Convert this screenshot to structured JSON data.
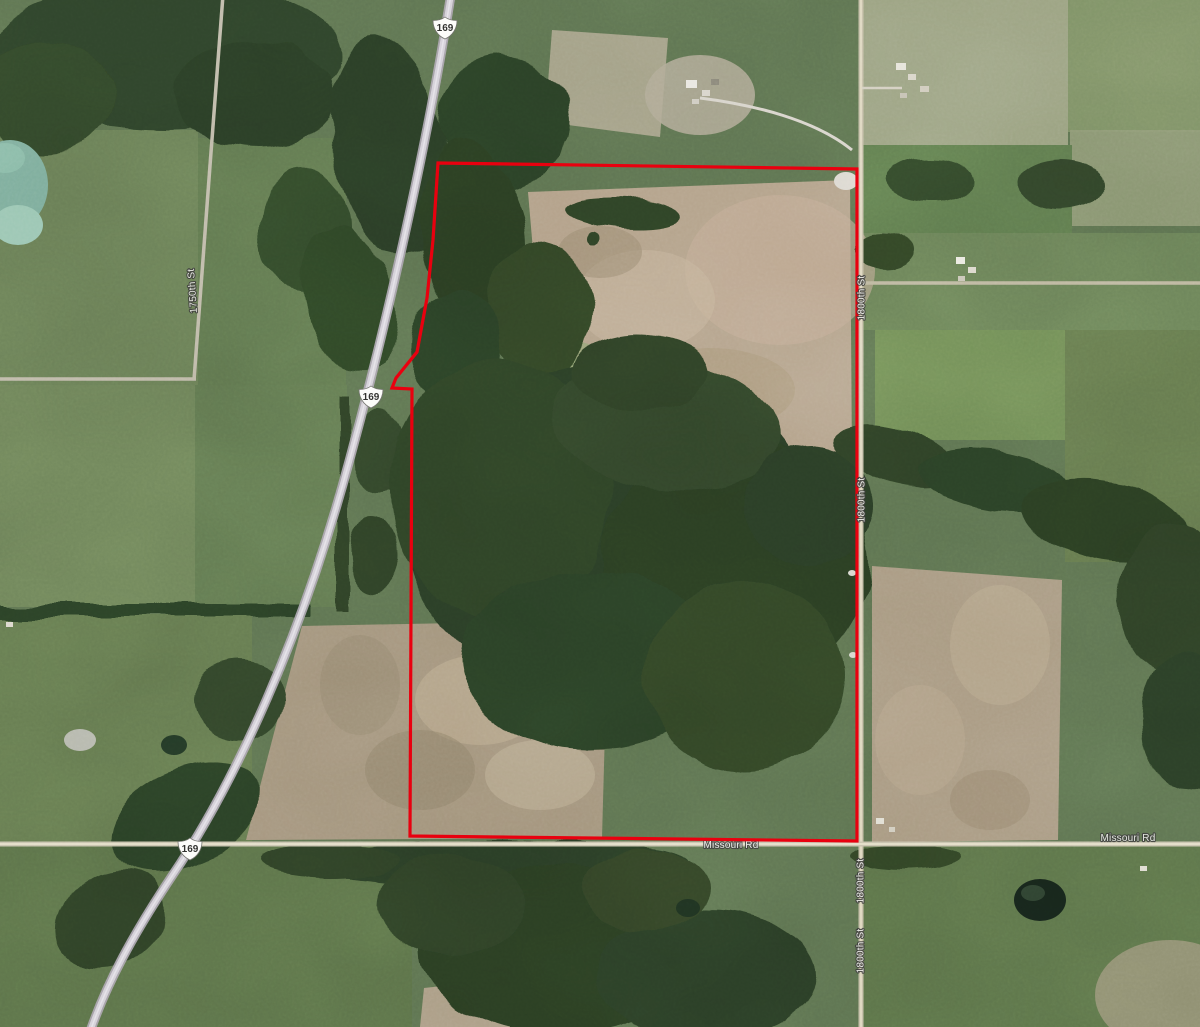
{
  "highway_shields": [
    {
      "label": "169"
    },
    {
      "label": "169"
    },
    {
      "label": "169"
    }
  ],
  "road_labels": {
    "missouri_rd_center": "Missouri Rd",
    "missouri_rd_east": "Missouri Rd",
    "right_road_upper": "1800th St",
    "right_road_middle": "1800th St",
    "right_road_lower_a": "1800th St",
    "right_road_lower_b": "1800th St",
    "left_road": "1750th St"
  },
  "boundary": {
    "stroke_color": "#e8000d",
    "points": "438,163 857,169 857,841 410,836 412,389 392,388 396,378 417,352 427,298 433,240"
  }
}
